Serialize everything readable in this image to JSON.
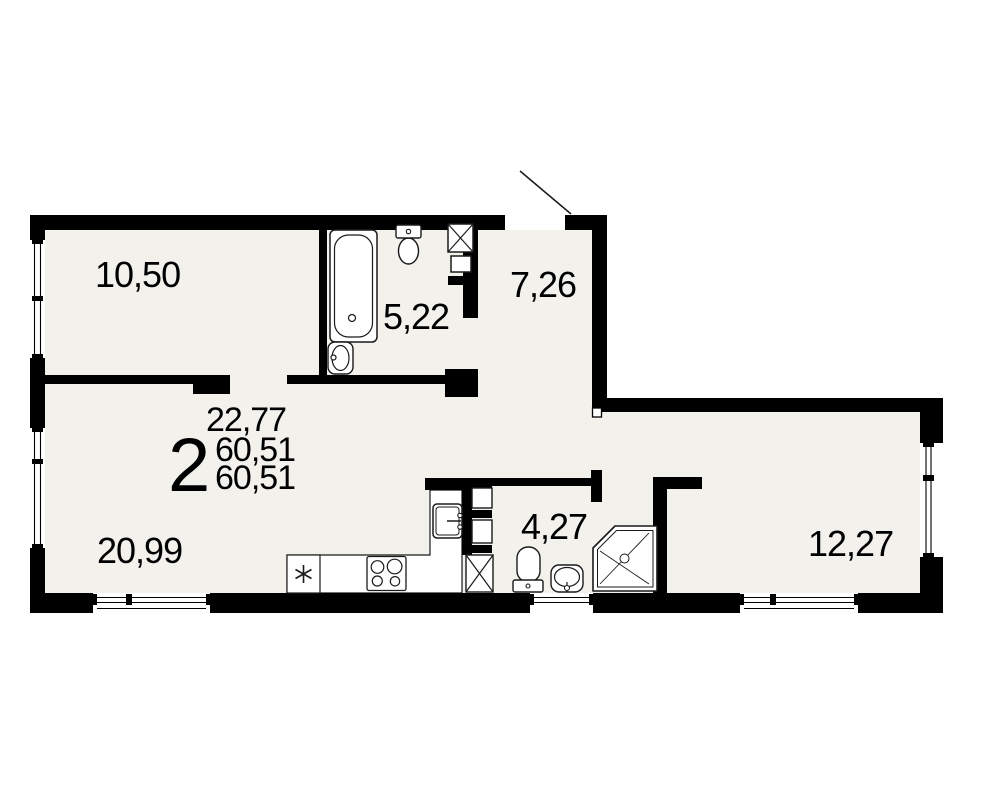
{
  "summary": {
    "rooms_count": "2",
    "living_area": "22,77",
    "total_area": "60,51",
    "total_area_2": "60,51"
  },
  "rooms": [
    {
      "name": "room-top-left",
      "area": "10,50"
    },
    {
      "name": "bathroom",
      "area": "5,22"
    },
    {
      "name": "hallway",
      "area": "7,26"
    },
    {
      "name": "living-kitchen",
      "area": "20,99"
    },
    {
      "name": "wc",
      "area": "4,27"
    },
    {
      "name": "room-right",
      "area": "12,27"
    }
  ],
  "fixtures": [
    "bathtub",
    "washbasin",
    "toilet",
    "ventilation-shaft",
    "kitchen-sink",
    "stove",
    "fridge",
    "shower-cabin",
    "entrance-door"
  ],
  "colors": {
    "wall": "#000000",
    "floor": "#f3f1ec",
    "fixture_stroke": "#1a1a1a",
    "background": "#ffffff"
  }
}
